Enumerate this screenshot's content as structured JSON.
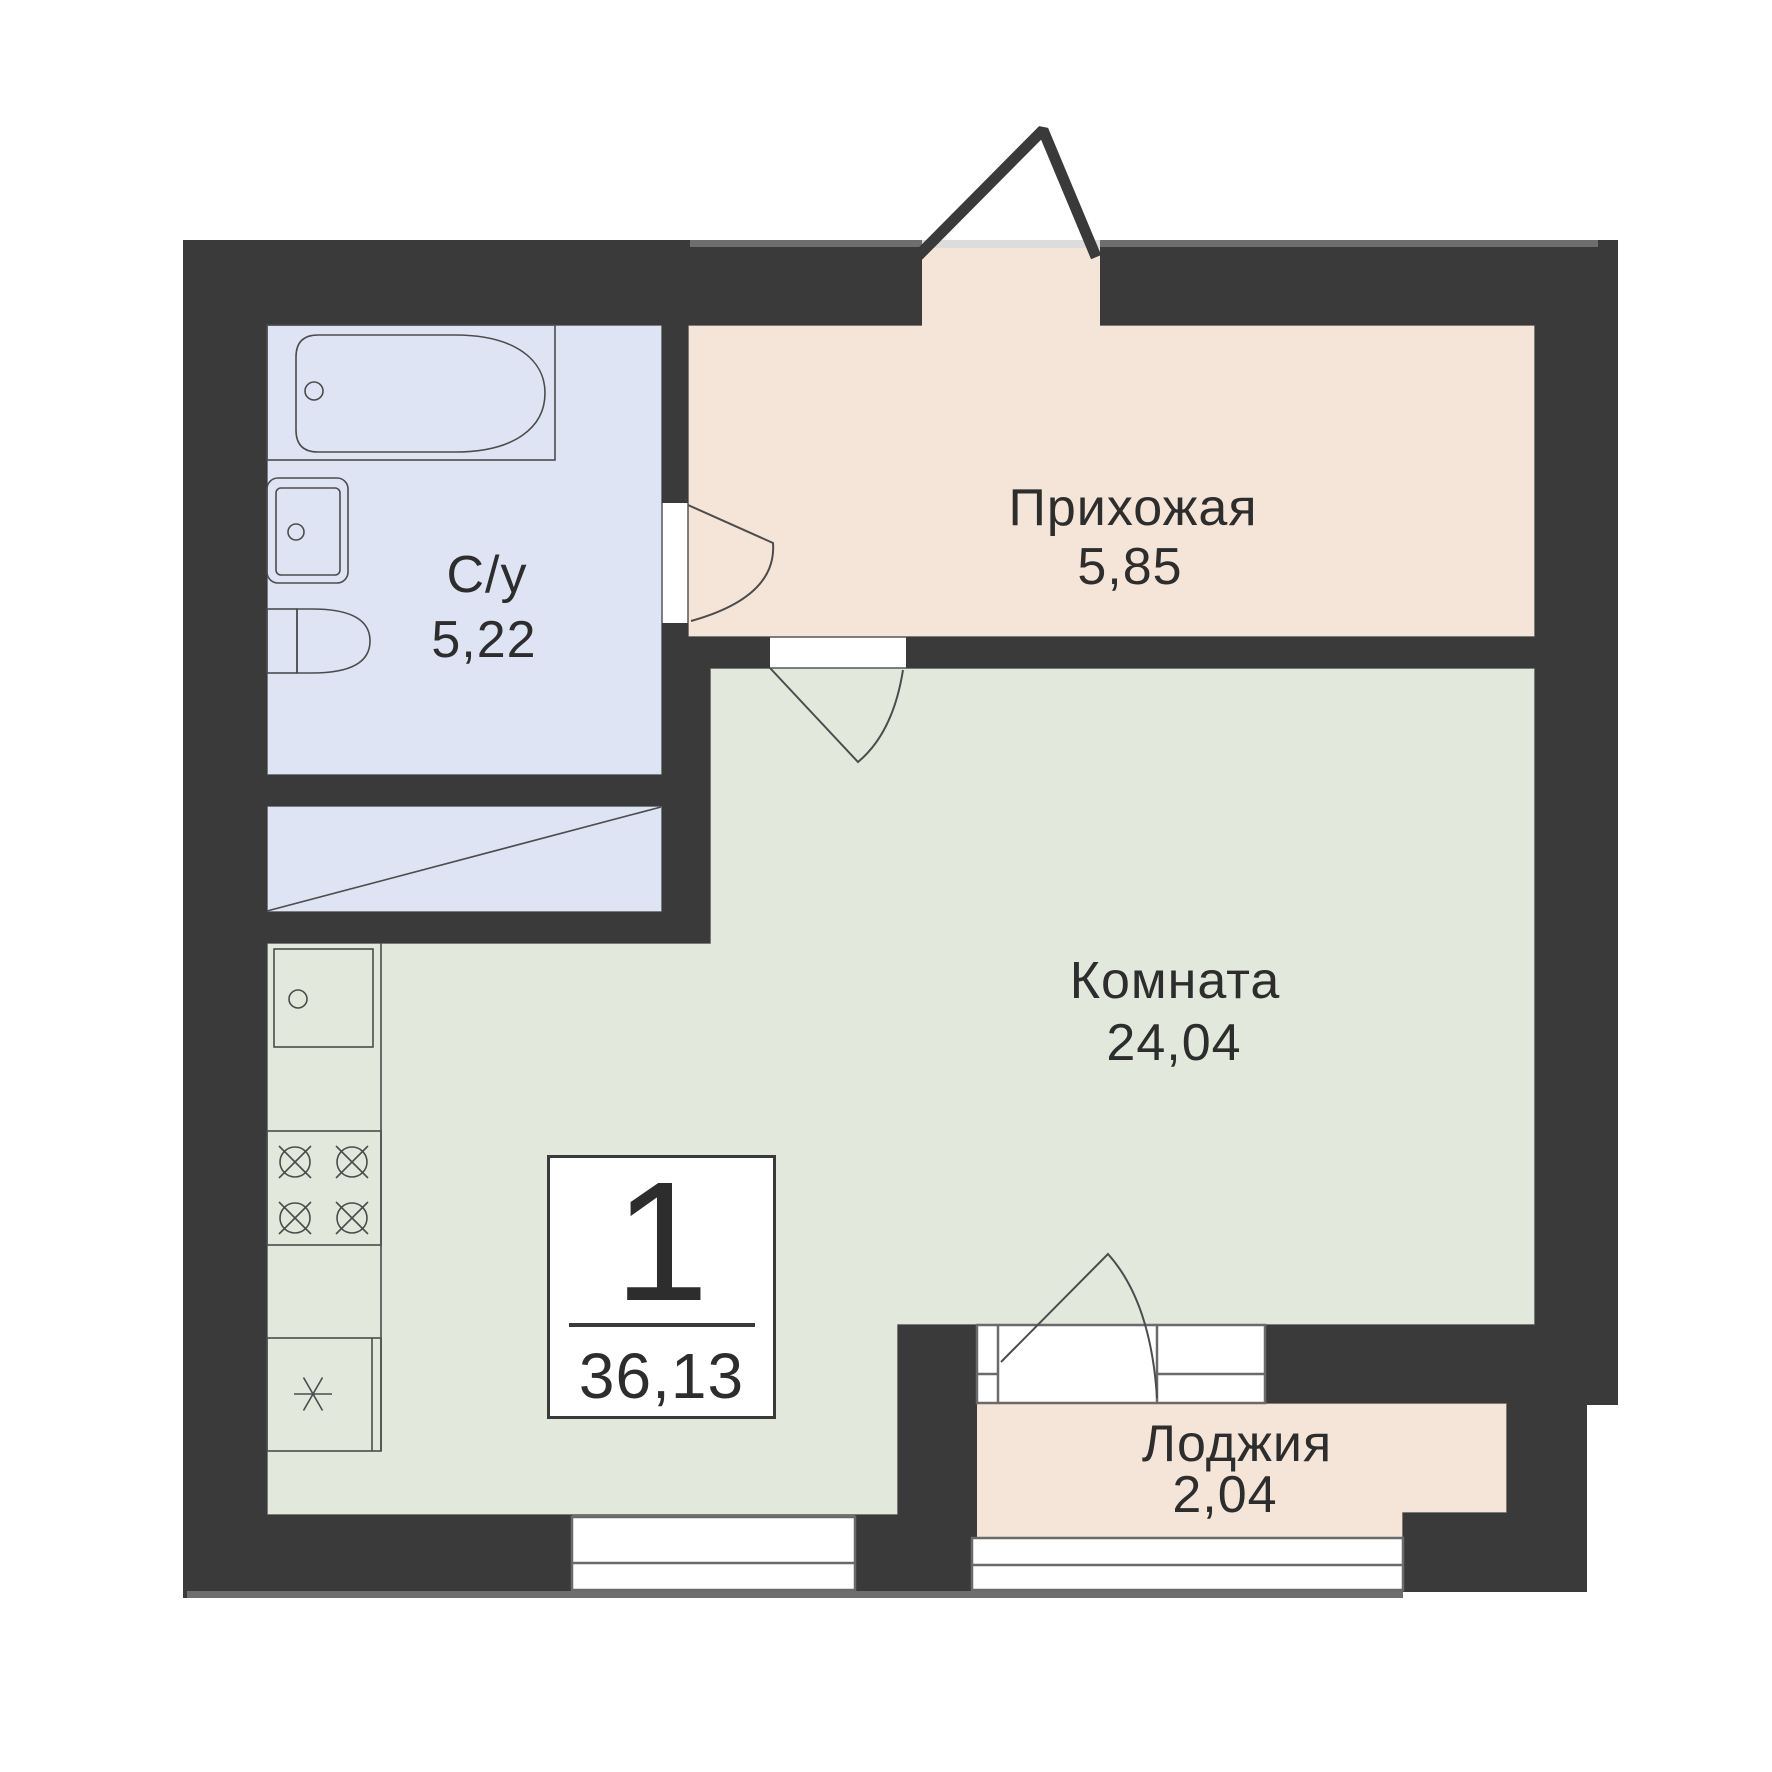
{
  "colors": {
    "paper": "#ffffff",
    "wall": "#3a3a3a",
    "hallway": "#f5e5d8",
    "loggia": "#f5e5d8",
    "bathroom": "#dfe4f5",
    "room": "#e2e8dc",
    "outline": "#565656",
    "line": "#4c4c4c",
    "frame": "#6a6a6a",
    "trim": "#6e6e6e",
    "threshold": "#dcdcdc",
    "text": "#2d2d2d"
  },
  "rooms": {
    "hallway": {
      "label": "Прихожая",
      "area": "5,85"
    },
    "bathroom": {
      "label": "С/у",
      "area": "5,22"
    },
    "living_room": {
      "label": "Комната",
      "area": "24,04"
    },
    "loggia": {
      "label": "Лоджия",
      "area": "2,04"
    }
  },
  "info_box": {
    "rooms_count": "1",
    "total_area": "36,13"
  },
  "icons": [
    "bathtub-icon",
    "washbasin-icon",
    "toilet-icon",
    "kitchen-sink-icon",
    "stove-icon",
    "fridge-icon",
    "door-swing-icon",
    "entrance-door-icon",
    "window-icon"
  ]
}
